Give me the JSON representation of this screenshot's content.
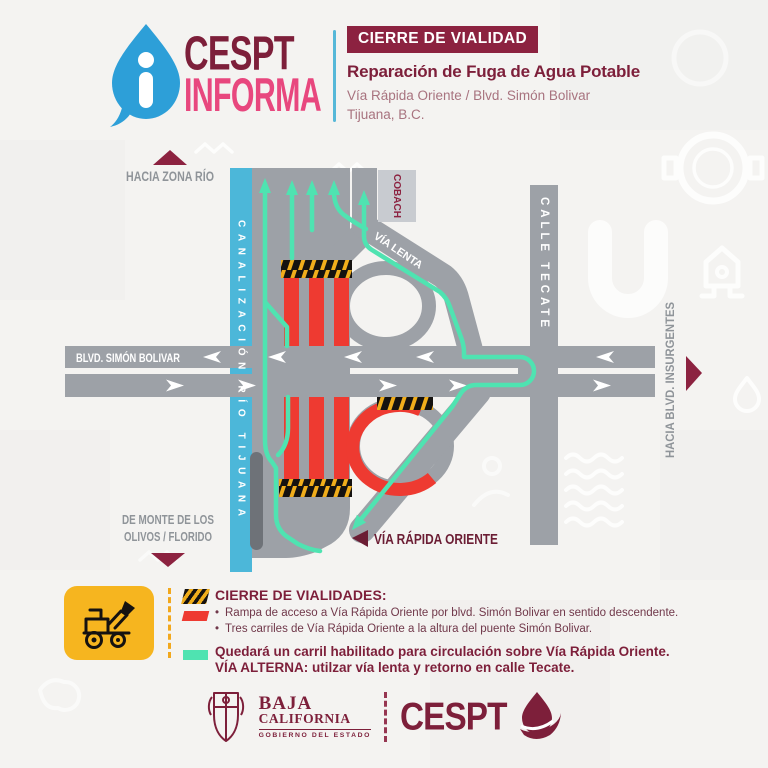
{
  "colors": {
    "maroon": "#8c2240",
    "maroon_dark": "#7d1f3a",
    "pink": "#e8477e",
    "logo_blue": "#2d9fd8",
    "canal_blue": "#4cb7d9",
    "road_gray": "#9da1a7",
    "label_gray": "#8f9499",
    "closure_red": "#ee3a31",
    "open_lane_teal": "#4fe3b1",
    "hazard_yellow": "#f0ad1b",
    "legend_yellow": "#f6b51f"
  },
  "header": {
    "logo_icon": "info-drop-icon",
    "logo_line1": "CESPT",
    "logo_line2": "INFORMA",
    "badge": "CIERRE DE VIALIDAD",
    "title": "Reparación de Fuga de Agua Potable",
    "subtitle": "Vía Rápida Oriente / Blvd. Simón Bolivar",
    "location": "Tijuana, B.C."
  },
  "map": {
    "hacia_zona_rio": "HACIA ZONA RÍO",
    "canalizacion": "CANALIZACIÓN RÍO TIJUANA",
    "cobach": "COBACH",
    "via_lenta": "VÍA LENTA",
    "calle_tecate": "CALLE TECATE",
    "blvd_simon_bolivar": "BLVD. SIMÓN BOLIVAR",
    "hacia_blvd_insurgentes": "HACIA BLVD. INSURGENTES",
    "de_monte_line1": "DE MONTE DE LOS",
    "de_monte_line2": "OLIVOS / FLORIDO",
    "via_rapida_oriente": "VÍA RÁPIDA ORIENTE"
  },
  "legend": {
    "heading": "CIERRE DE VIALIDADES:",
    "items": [
      "Rampa de acceso a Vía Rápida Oriente por blvd. Simón Bolivar en sentido descendente.",
      "Tres carriles de Vía Rápida Oriente a la altura del puente Simón Bolivar."
    ],
    "open_line1": "Quedará un carril habilitado para circulación sobre Vía Rápida Oriente.",
    "open_line2": "VÍA ALTERNA: utilzar vía lenta y retorno en calle Tecate."
  },
  "footer": {
    "gov_line1": "BAJA",
    "gov_line2": "CALIFORNIA",
    "gov_line3": "GOBIERNO DEL ESTADO",
    "brand": "CESPT"
  }
}
